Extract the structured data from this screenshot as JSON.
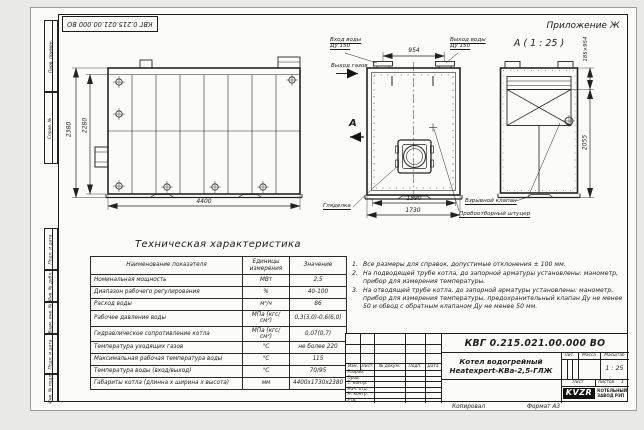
{
  "sheet": {
    "appendix_label": "Приложение Ж",
    "top_stamp_number": "КВГ 0.215.021.00.000 ВО",
    "margin_labels": {
      "perv_primen": "Перв. примен.",
      "sprav_no": "Справ. №",
      "podp_data_1": "Подп. и дата",
      "inv_dubl": "Инв. № дубл.",
      "vzam_inv": "Взам. инв. №",
      "podp_data_2": "Подп. и дата",
      "inv_podl": "Инв. № подл.",
      "copied": "Копировал",
      "format": "Формат А3"
    }
  },
  "views": {
    "side_view": {
      "dim_height_outer": "2380",
      "dim_height_inner": "2280",
      "dim_length": "4400"
    },
    "front_view": {
      "water_inlet_line1": "Вход воды",
      "water_inlet_line2": "Ду 150",
      "water_outlet_line1": "Выход воды",
      "water_outlet_line2": "Ду 150",
      "gas_outlet": "Выход газов",
      "dim_nozzle_spacing": "954",
      "section_letter": "А",
      "dim_width_inner": "1590",
      "dim_width_outer": "1730",
      "sight_glass": "Гляделка"
    },
    "section_view": {
      "title": "А ( 1 : 25 )",
      "dim_opening": "185×954",
      "dim_height": "2055",
      "explosion_valve": "Взрывной клапан",
      "sampling_fitting": "Пробоотборный штуцер"
    }
  },
  "spec_table": {
    "title": "Техническая характеристика",
    "headers": [
      "Наименование показателя",
      "Единицы измерения",
      "Значение"
    ],
    "rows": [
      {
        "name": "Номинальная мощность",
        "unit": "МВт",
        "value": "2,5"
      },
      {
        "name": "Диапазон рабочего регулирования",
        "unit": "%",
        "value": "40-100"
      },
      {
        "name": "Расход воды",
        "unit": "м³/ч",
        "value": "86"
      },
      {
        "name": "Рабочее давление воды",
        "unit": "МПа (кгс/см²)",
        "value": "0,3(3,0)-0,6(6,0)"
      },
      {
        "name": "Гидравлическое сопротивление котла",
        "unit": "МПа (кгс/см²)",
        "value": "0,07(0,7)"
      },
      {
        "name": "Температура уходящих газов",
        "unit": "°С",
        "value": "не более 220"
      },
      {
        "name": "Максимальная рабочая температура воды",
        "unit": "°С",
        "value": "115"
      },
      {
        "name": "Температура воды (вход/выход)",
        "unit": "°С",
        "value": "70/95"
      },
      {
        "name": "Габариты котла (длинна х ширина х высота)",
        "unit": "мм",
        "value": "4400х1730х2380"
      }
    ]
  },
  "notes": {
    "items": [
      {
        "num": "1.",
        "text": "Все размеры для справок, допустимые отклонения ± 100 мм."
      },
      {
        "num": "2.",
        "text": "На подводящей трубе котла, до запорной арматуры установлены: манометр, прибор для измерения температуры."
      },
      {
        "num": "3.",
        "text": "На отводящей трубе котла, до запорной арматуры установлены: манометр, прибор для измерения температуры, предохранительный клапан Ду не менее 50 и обвод с обратным клапаном Ду не менее 50 мм."
      }
    ]
  },
  "title_block": {
    "doc_number": "КВГ 0.215.021.00.000 ВО",
    "product_name_line1": "Котел водогрейный",
    "product_name_line2": "Heatexpert-КВа-2,5-ГЛЖ",
    "header_cells": {
      "izm": "Изм.",
      "list": "Лист",
      "doc": "№ докум.",
      "podp": "Подп.",
      "data": "Дата"
    },
    "sig_rows": [
      "Разраб.",
      "Пров.",
      "Т. контр.",
      "Нач. отд.",
      "Н. контр.",
      "Утв."
    ],
    "lit_label": "Лит.",
    "mass_label": "Масса",
    "scale_label": "Масштаб",
    "scale_value": "1 : 25",
    "sheet_label": "Лист",
    "sheets_label": "Листов",
    "sheets_value": "1",
    "logo_text": "KVZR",
    "company_line1": "КОТЕЛЬНЫЙ",
    "company_line2": "ЗАВОД РЭП"
  }
}
